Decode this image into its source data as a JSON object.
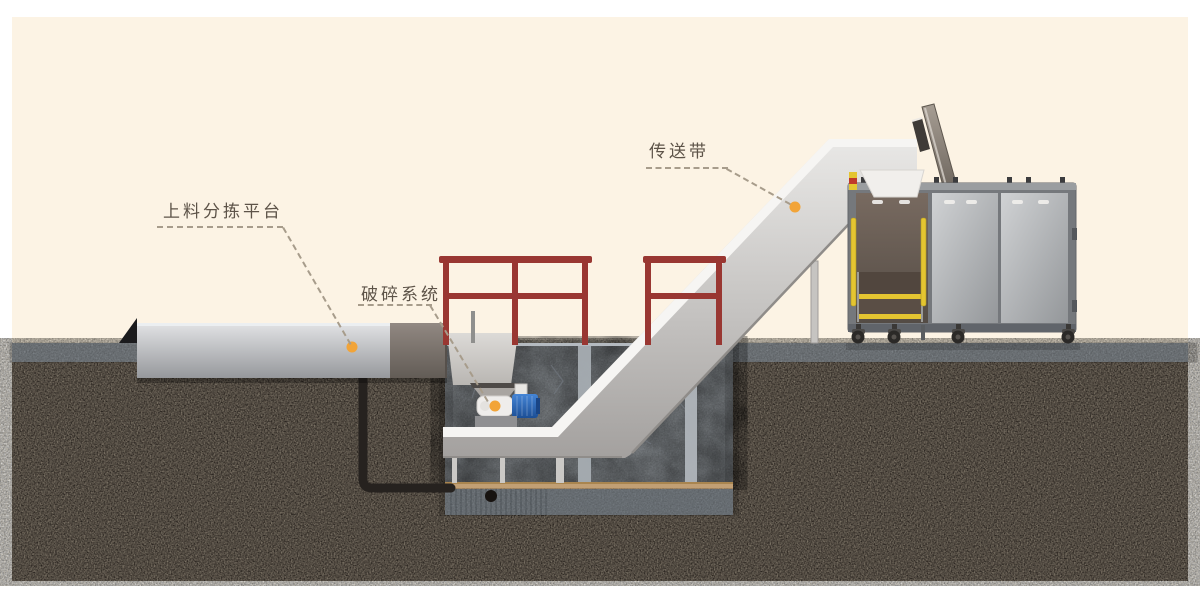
{
  "diagram": {
    "description": "Cross-section infographic of a waste feeding, crushing and conveying line with processing machine",
    "labels": {
      "loading_platform": "上料分拣平台",
      "crushing_system": "破碎系统",
      "conveyor_belt": "传送带"
    }
  },
  "palette": {
    "cream": "#fcf3e4",
    "soil": "#4a4038",
    "slab": "#868c91",
    "concrete": "#9ba1a6",
    "tan": "#c19f74",
    "railing": "#993732",
    "marker": "#f2a438",
    "ink": "#5d5348",
    "leader": "#a79c8b",
    "belt-top": "#f6f5f3",
    "machine-frame": "#75787c",
    "panel-dark": "#6b6057",
    "yellow": "#e4c531",
    "motor-blue": "#2f6fc0"
  }
}
